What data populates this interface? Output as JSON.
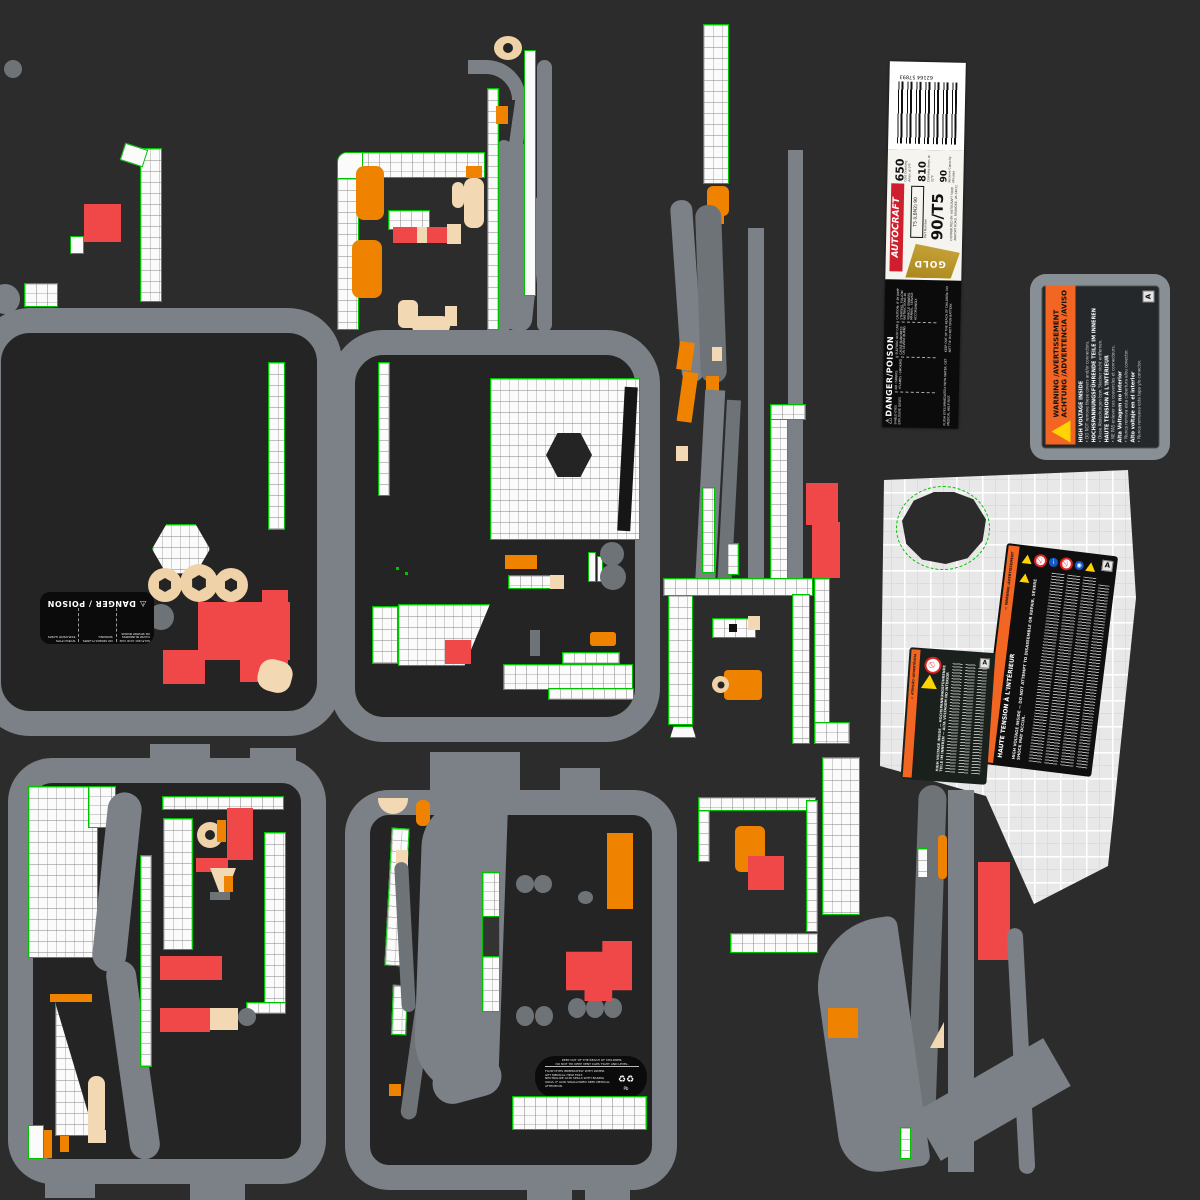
{
  "colors": {
    "background": "#2d2c2c",
    "uv_green": "#00c300",
    "island_gray": "#e8e8e8",
    "outline_gray": "#7b8187",
    "orange": "#ef8300",
    "red": "#f04848",
    "tan": "#f3d8b4",
    "label_orange": "#f26522",
    "gold": "#ab881e"
  },
  "battery_label": {
    "barcode_text": "62164 57893",
    "brand": "AUTOCRAFT",
    "tier": "GOLD",
    "part_label": "Part Number",
    "part_number": "90/T5",
    "cca_value": "650",
    "cca_label": "Cold Cranking Amps at 0°F",
    "ca_value": "810",
    "ca_label": "Cranking Amps at 32°F",
    "rc_value": "90",
    "rc_label": "Reserve Capacity Minutes",
    "group_code": "T5 (LBN2) 90",
    "distributor": "DISTRIBUTED BY: AUTOCRAFT 5008 AIRPORT ROAD, ROANOKE, VA 24012",
    "danger": {
      "title": "⚠DANGER/POISON",
      "col1": "SHIELD EYES EXPLOSIVE GASES",
      "col2": "NO •SPARKS •FLAMES •SMOKING",
      "col3": "SULFURIC ACID CAN CAUSE BLINDNESS OR SEVERE BURNS",
      "note1": "FLUSH EYES IMMEDIATELY WITH WATER. GET MEDICAL HELP FAST.",
      "note2": "CAUTION: IF BY JUMP STARTING, FOLLOW INSTRUCTIONS IN VEHICLE OWNERS MANUAL. SERVICE ACCORDINGLY.",
      "footer": "KEEP OUT OF THE REACH OF CHILDREN. DO NOT TIP. DO NOT OPEN BATTERY."
    }
  },
  "hv_label": {
    "header1": "WARNING /AVERTISSEMENT",
    "header2": "ACHTUNG /ADVERTENCIA /AVISO",
    "sections": [
      {
        "t": "HIGH VOLTAGE INSIDE",
        "b": "• DO NOT remove these covers and/or connectors."
      },
      {
        "t": "HOCHSPANNUNGSFÜHRENDE TEILE IM INNEREN",
        "b": "• Diese Abdeckungen bzw. Stecker nicht entfernen."
      },
      {
        "t": "HAUTE TENSION À L'INTÉRIEUR",
        "b": "• NE PAS enlever ces couvercles et connecteurs."
      },
      {
        "t": "Alta Voltagem no interior",
        "b": "• Nunca remova esta cobertura e/ou conector."
      },
      {
        "t": "Alto voltaje en el interior",
        "b": "• Nunca remueva esta tapa y/o conector."
      }
    ],
    "corner_mark": "A"
  },
  "poison_label": {
    "title": "⚠ DANGER / POISON",
    "col1": "SULFURIC ACID CAN CAUSE BLINDNESS OR SEVERE BURNS",
    "col2": "NO SPARKS FLAMES SMOKING",
    "col3": "SHIELD EYES EXPLOSIVE GASES"
  },
  "island_label_main": {
    "side_band": "⚠ WARNING /AVERTISSEMENT",
    "side_title": "HAUTE TENSION À L'INTÉRIEUR",
    "heading": "HIGH VOLTAGE INSIDE — DO NOT ATTEMPT TO DISASSEMBLE OR REPAIR. SEVERE SHOCK MAY OCCUR.",
    "corner_mark": "A"
  },
  "island_label_small": {
    "side_band": "⚠ ATENÇÃO /ADVERTÊNCIA",
    "heading": "HIGH VOLTAGE INSIDE — HOCHSPANNUNGSFÜHRENDE TEILE IM INNEREN — ALTA VOLTAGEM NO INTERIOR",
    "corner_mark": "A"
  },
  "keepout_label": {
    "line1": "KEEP OUT OF THE REACH OF CHILDREN.",
    "line2": "DO NOT TIP. KEEP VENT CAPS TIGHT AND LEVEL.",
    "line3": "FLUSH EYES IMMEDIATELY WITH WATER. GET MEDICAL HELP FAST.",
    "line4": "NEUTRALIZE ACID SPILLS WITH BAKING SODA. IF ACID SWALLOWED SEEK MEDICAL ATTENTION.",
    "recycle_icon": "♻",
    "recycle_mark": "Pb"
  }
}
